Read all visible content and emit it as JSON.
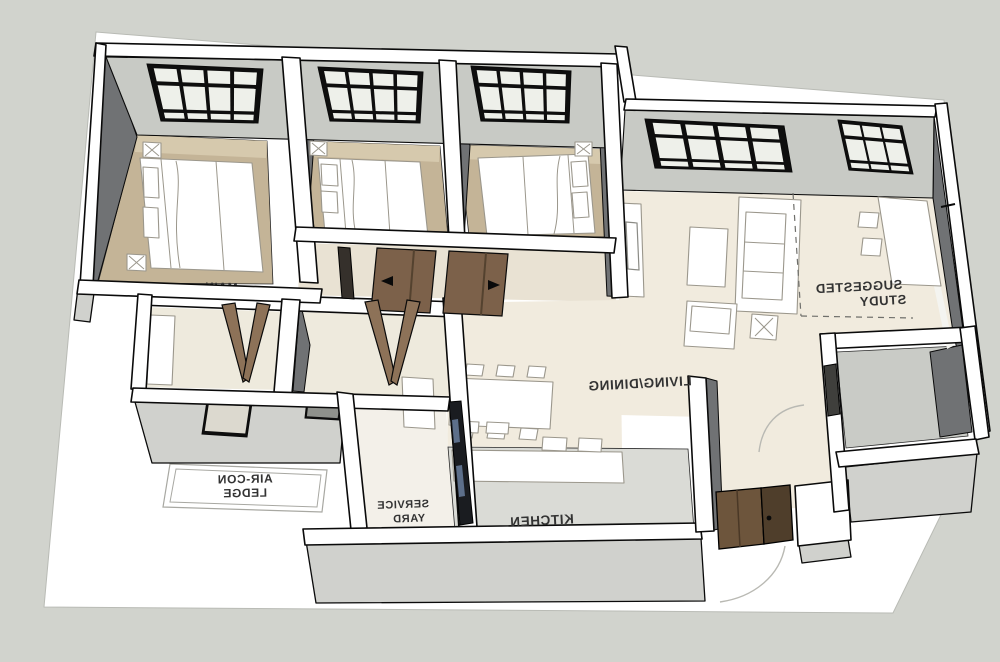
{
  "scene": {
    "type": "3d-floorplan-axonometric-render",
    "note": "room labels appear mirrored (model viewed from rear)"
  },
  "labels": {
    "master_bedroom": "MAIN",
    "living_dining": "LIVING/DINING",
    "kitchen": "KITCHEN",
    "service_yard": [
      "SERVICE",
      "YARD"
    ],
    "aircon_ledge": [
      "AIR-CON",
      "LEDGE"
    ],
    "suggested_study": [
      "SUGGESTED",
      "STUDY"
    ]
  },
  "palette": {
    "background": "#d1d3cd",
    "ground": "#ffffff",
    "wall_top": "#ffffff",
    "wall_outer": "#d0d1cd",
    "wall_face_light": "#c8cac5",
    "wall_face_dark": "#707274",
    "floor_bedroom": "#c4b497",
    "floor_bedroom_light": "#d6c9ad",
    "floor_living": "#f1ebde",
    "floor_corridor": "#e9e2d3",
    "floor_bath": "#eeeadd",
    "floor_kitchen": "#dadbd6",
    "floor_service": "#f3f0e9",
    "floor_store": "#c9cbc6",
    "furniture": "#ffffff",
    "furniture_line": "#9b978c",
    "door_wood": "#7c614a",
    "door_wood_dark": "#54422f",
    "door_bifold": "#8d7258",
    "window_frame": "#0e0e0e",
    "glass": "#eef0ea",
    "label": "#333333",
    "outline": "#0a0a0a",
    "swing_arc": "#b9b9b3"
  }
}
